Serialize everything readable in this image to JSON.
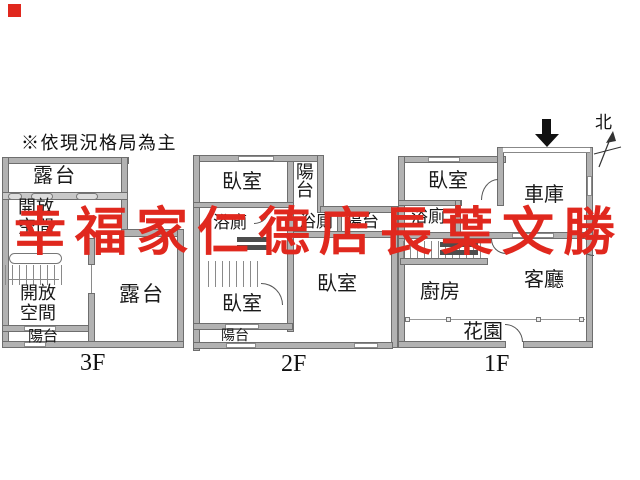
{
  "note": "※依現況格局為主",
  "watermark": {
    "text": "幸福家仁德店長葉文勝",
    "color": "#e0281e"
  },
  "compass": {
    "label": "北"
  },
  "colors": {
    "wall_fill": "#b2b2b2",
    "wall_edge": "#6e6e6e",
    "text": "#1a1a1a",
    "watermark_red": "#e0281e"
  },
  "floors": [
    {
      "tag": "3F",
      "rooms": {
        "terrace_top": "露台",
        "open1": "開放",
        "open2": "空間",
        "terrace_main": "露台",
        "balcony": "陽台"
      }
    },
    {
      "tag": "2F",
      "rooms": {
        "bedroom_top": "臥室",
        "balcony_side": "陽台",
        "bath_left": "浴廁",
        "bedroom_bottom": "臥室",
        "balcony_bottom": "陽台",
        "bath_right": "浴廁",
        "balcony_right": "陽台",
        "bedroom_main": "臥室"
      }
    },
    {
      "tag": "1F",
      "rooms": {
        "bedroom": "臥室",
        "garage": "車庫",
        "bath": "浴廁",
        "kitchen": "廚房",
        "living": "客廳",
        "garden": "花園"
      }
    }
  ]
}
